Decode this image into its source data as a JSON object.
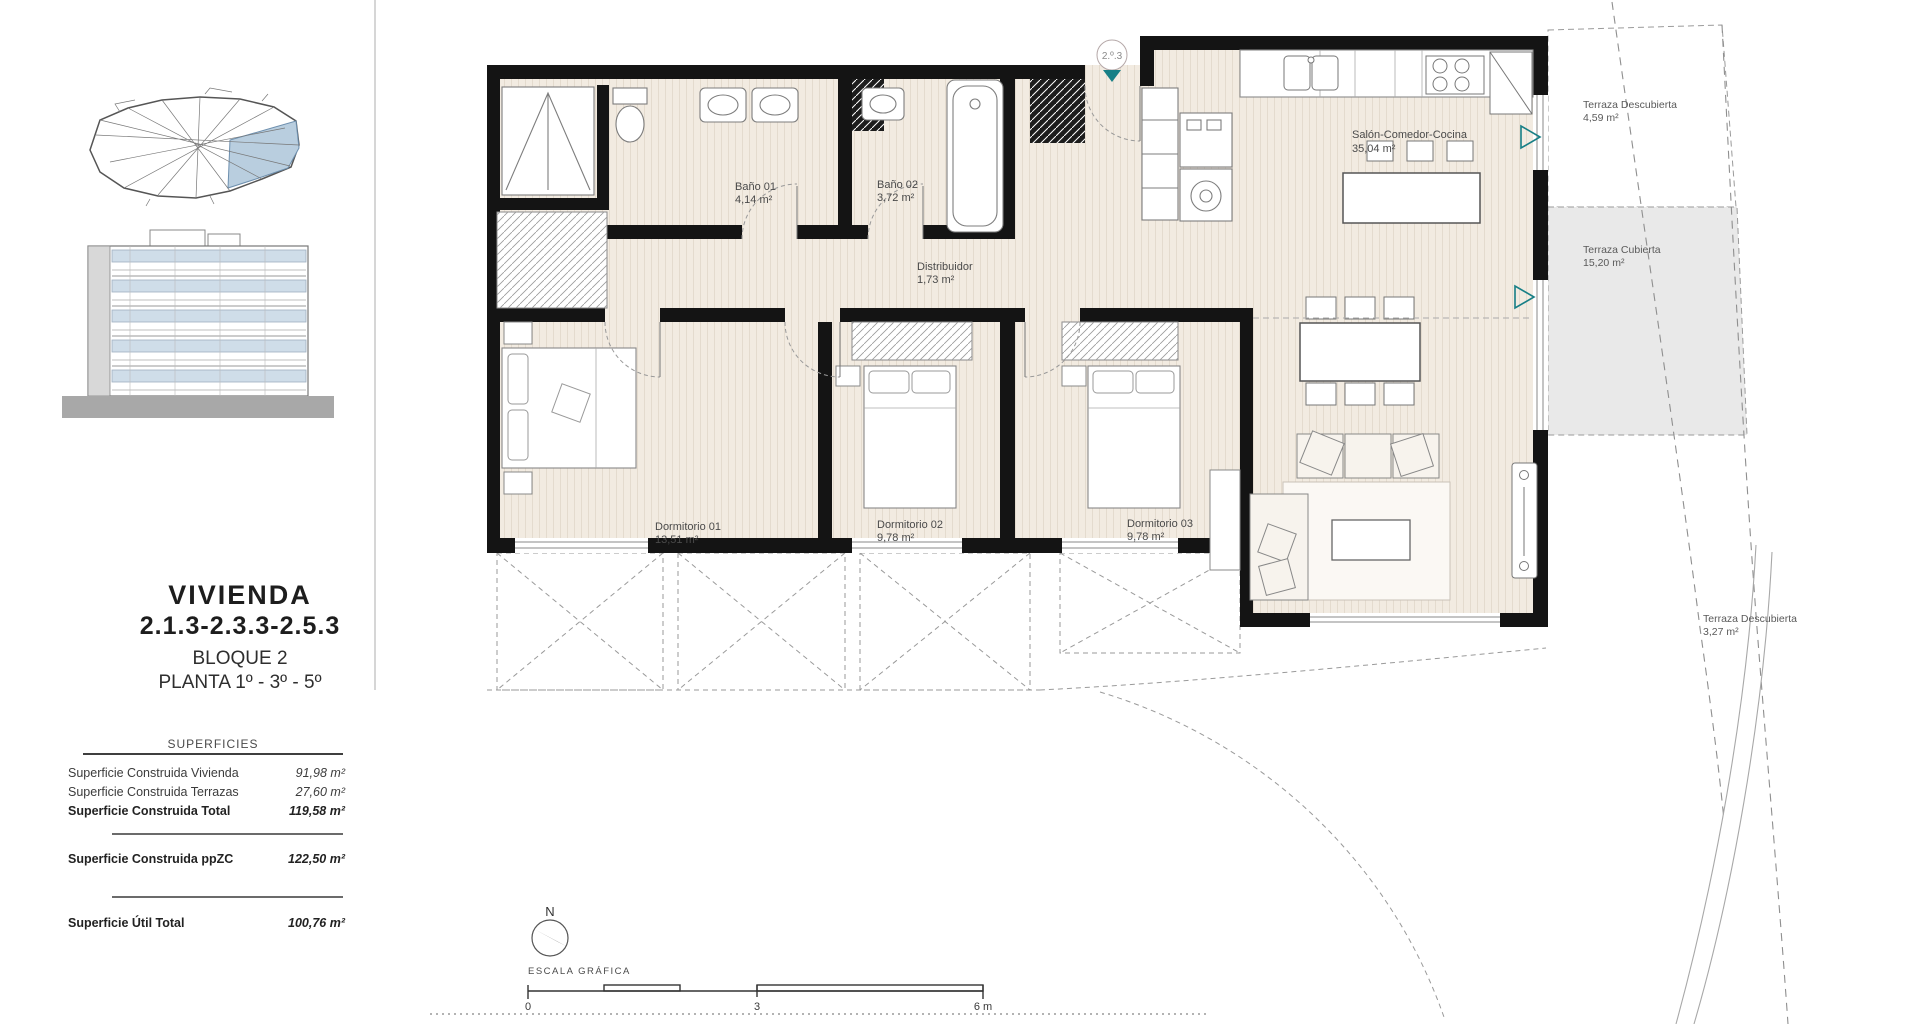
{
  "sidebar": {
    "title": "VIVIENDA",
    "code": "2.1.3-2.3.3-2.5.3",
    "block": "BLOQUE 2",
    "floors": "PLANTA 1º - 3º - 5º",
    "surfaces": {
      "header": "SUPERFICIES",
      "rows": [
        {
          "label": "Superficie Construida Vivienda",
          "value": "91,98 m²"
        },
        {
          "label": "Superficie Construida Terrazas",
          "value": "27,60 m²"
        },
        {
          "label": "Superficie Construida Total",
          "value": "119,58 m²"
        },
        {
          "label": "Superficie Construida ppZC",
          "value": "122,50 m²"
        },
        {
          "label": "Superficie Útil Total",
          "value": "100,76 m²"
        }
      ]
    }
  },
  "plan": {
    "unit_marker": "2.º.3",
    "rooms": [
      {
        "name": "Baño 01",
        "area": "4,14 m²"
      },
      {
        "name": "Baño 02",
        "area": "3,72 m²"
      },
      {
        "name": "Distribuidor",
        "area": "1,73 m²"
      },
      {
        "name": "Salón-Comedor-Cocina",
        "area": "35,04 m²"
      },
      {
        "name": "Dormitorio 01",
        "area": "13,51 m²"
      },
      {
        "name": "Dormitorio 02",
        "area": "9,78 m²"
      },
      {
        "name": "Dormitorio 03",
        "area": "9,78 m²"
      }
    ],
    "terraces": [
      {
        "name": "Terraza Descubierta",
        "area": "4,59 m²"
      },
      {
        "name": "Terraza Cubierta",
        "area": "15,20 m²"
      },
      {
        "name": "Terraza Descubierta",
        "area": "3,27 m²"
      }
    ]
  },
  "compass": {
    "north": "N"
  },
  "scale": {
    "label": "ESCALA GRÁFICA",
    "tick0": "0",
    "tick3": "3",
    "tick6": "6 m"
  },
  "colors": {
    "teal": "#177f86",
    "floor": "#f2ebe1",
    "terrace_gray": "#e9e9e9",
    "site_blue": "#b9cedf",
    "wall": "#141414"
  }
}
